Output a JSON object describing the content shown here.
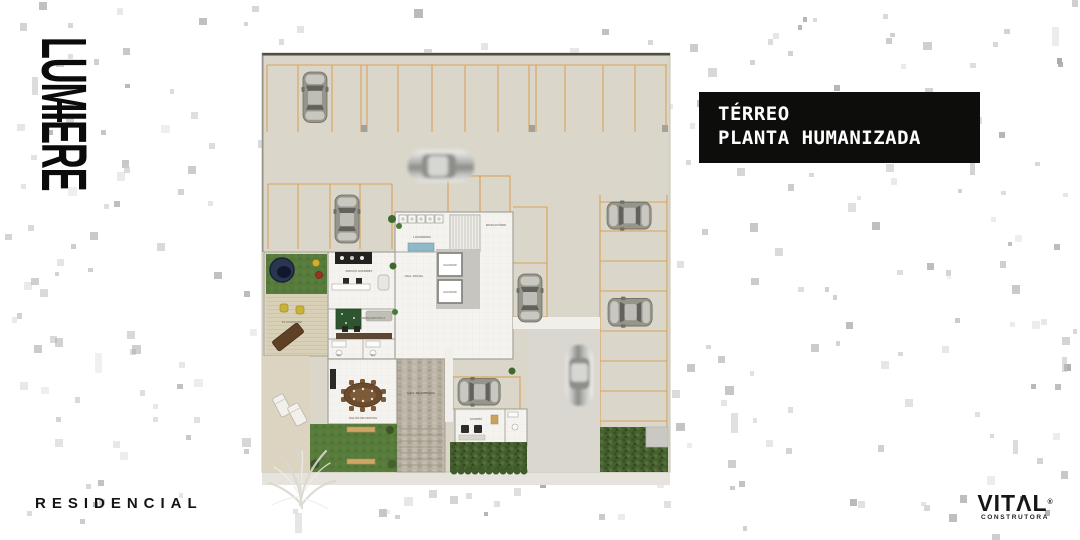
{
  "branding": {
    "lumiere": {
      "wordmark": "LUMIERE",
      "diaeresis_dots": 3
    },
    "residencial": "RESIDENCIAL",
    "vital": {
      "wordmark": "VITΛL",
      "registered": "®",
      "subtitle": "CONSTRUTORA"
    }
  },
  "title_box": {
    "line1": "TÉRREO",
    "line2": "PLANTA HUMANIZADA",
    "bg": "#0d0d0c",
    "fg": "#ffffff"
  },
  "floorplan": {
    "labels": {
      "lavanderia": "LAVANDERIA",
      "bicicletario": "BICICLETÁRIO",
      "elevador": "ELEVADOR",
      "hall_social": "HALL SOCIAL",
      "espaco_gourmet": "ESPAÇO GOURMET",
      "brinquedoteca": "BRINQUEDOTECA",
      "wc": "WC",
      "salao_de_festas": "SALÃO DE FESTAS",
      "hall_de_entrada": "HALL DE ENTRADA",
      "guarita": "GUARITA",
      "playground": "PLAYGROUND"
    },
    "parking": {
      "top_row_stalls": 13,
      "left_block_stalls": 4,
      "center_stalls": 4,
      "right_column_stalls": 7,
      "parked_cars": 6,
      "moving_cars": 2
    },
    "palette": {
      "paving": "#DAD7CA",
      "stall_lines": "#D9A15B",
      "building_floor": "#F4F3EF",
      "grass": "#567B3B",
      "hedge": "#46612F",
      "wood_deck": "#D9D0B8",
      "stone": "#BAB3A6",
      "sidewalk": "#E5E3DB",
      "water_feature": "#2A3550"
    }
  }
}
